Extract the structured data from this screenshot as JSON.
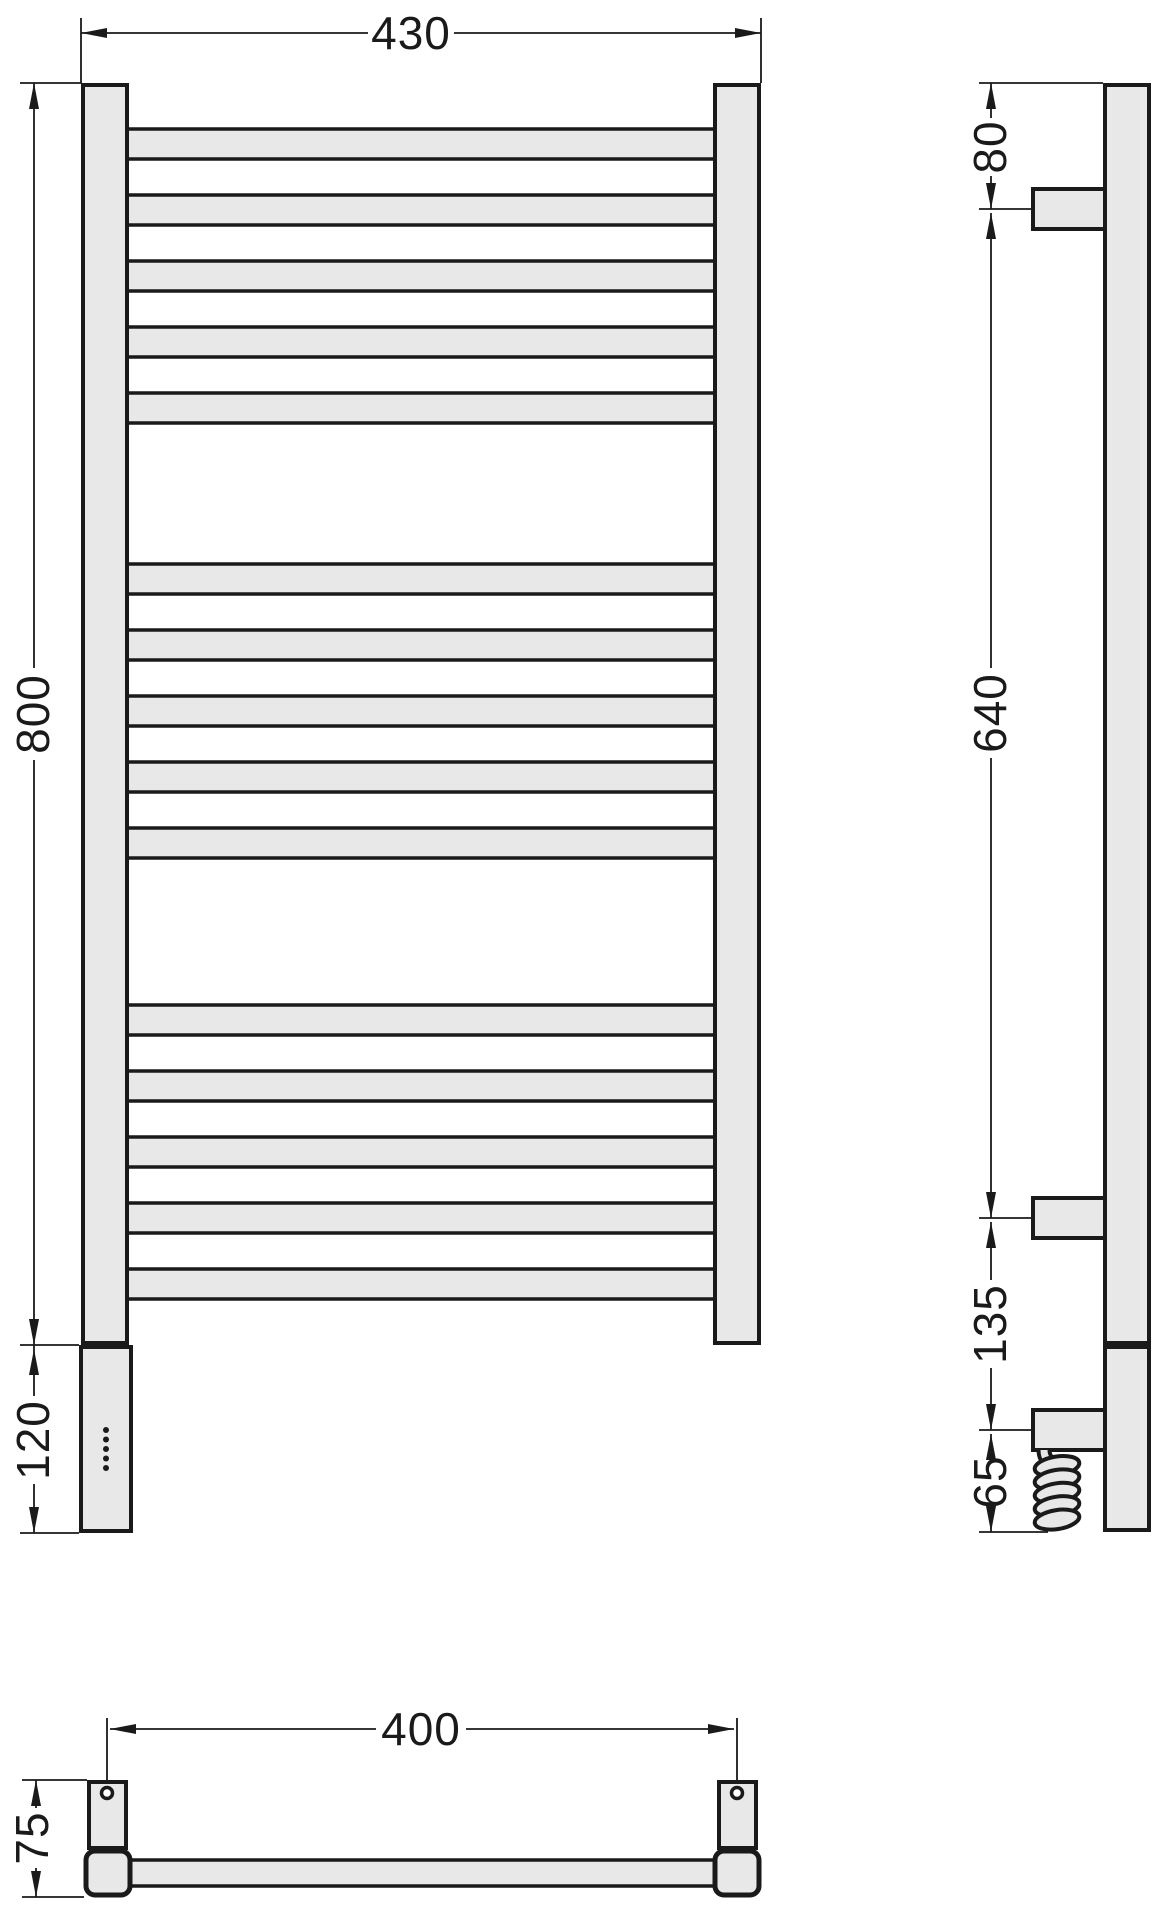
{
  "drawing": {
    "type": "technical-dimension-drawing",
    "subject": "ladder towel radiator with electric element",
    "colors": {
      "outline": "#1a1a1a",
      "fill": "#e8e8e8",
      "background": "#ffffff"
    },
    "front_view": {
      "width_label": "430",
      "height_label": "800",
      "housing_height_label": "120",
      "bar_groups": [
        5,
        5,
        5
      ],
      "indicator_dots": 5
    },
    "side_view": {
      "top_offset_label": "80",
      "bracket_span_label": "640",
      "lower_offset_label": "135",
      "cable_drop_label": "65",
      "brackets": 3,
      "cable_coil_loops": 5
    },
    "bottom_view": {
      "mount_centers_label": "400",
      "depth_label": "75",
      "feet": 2
    }
  }
}
